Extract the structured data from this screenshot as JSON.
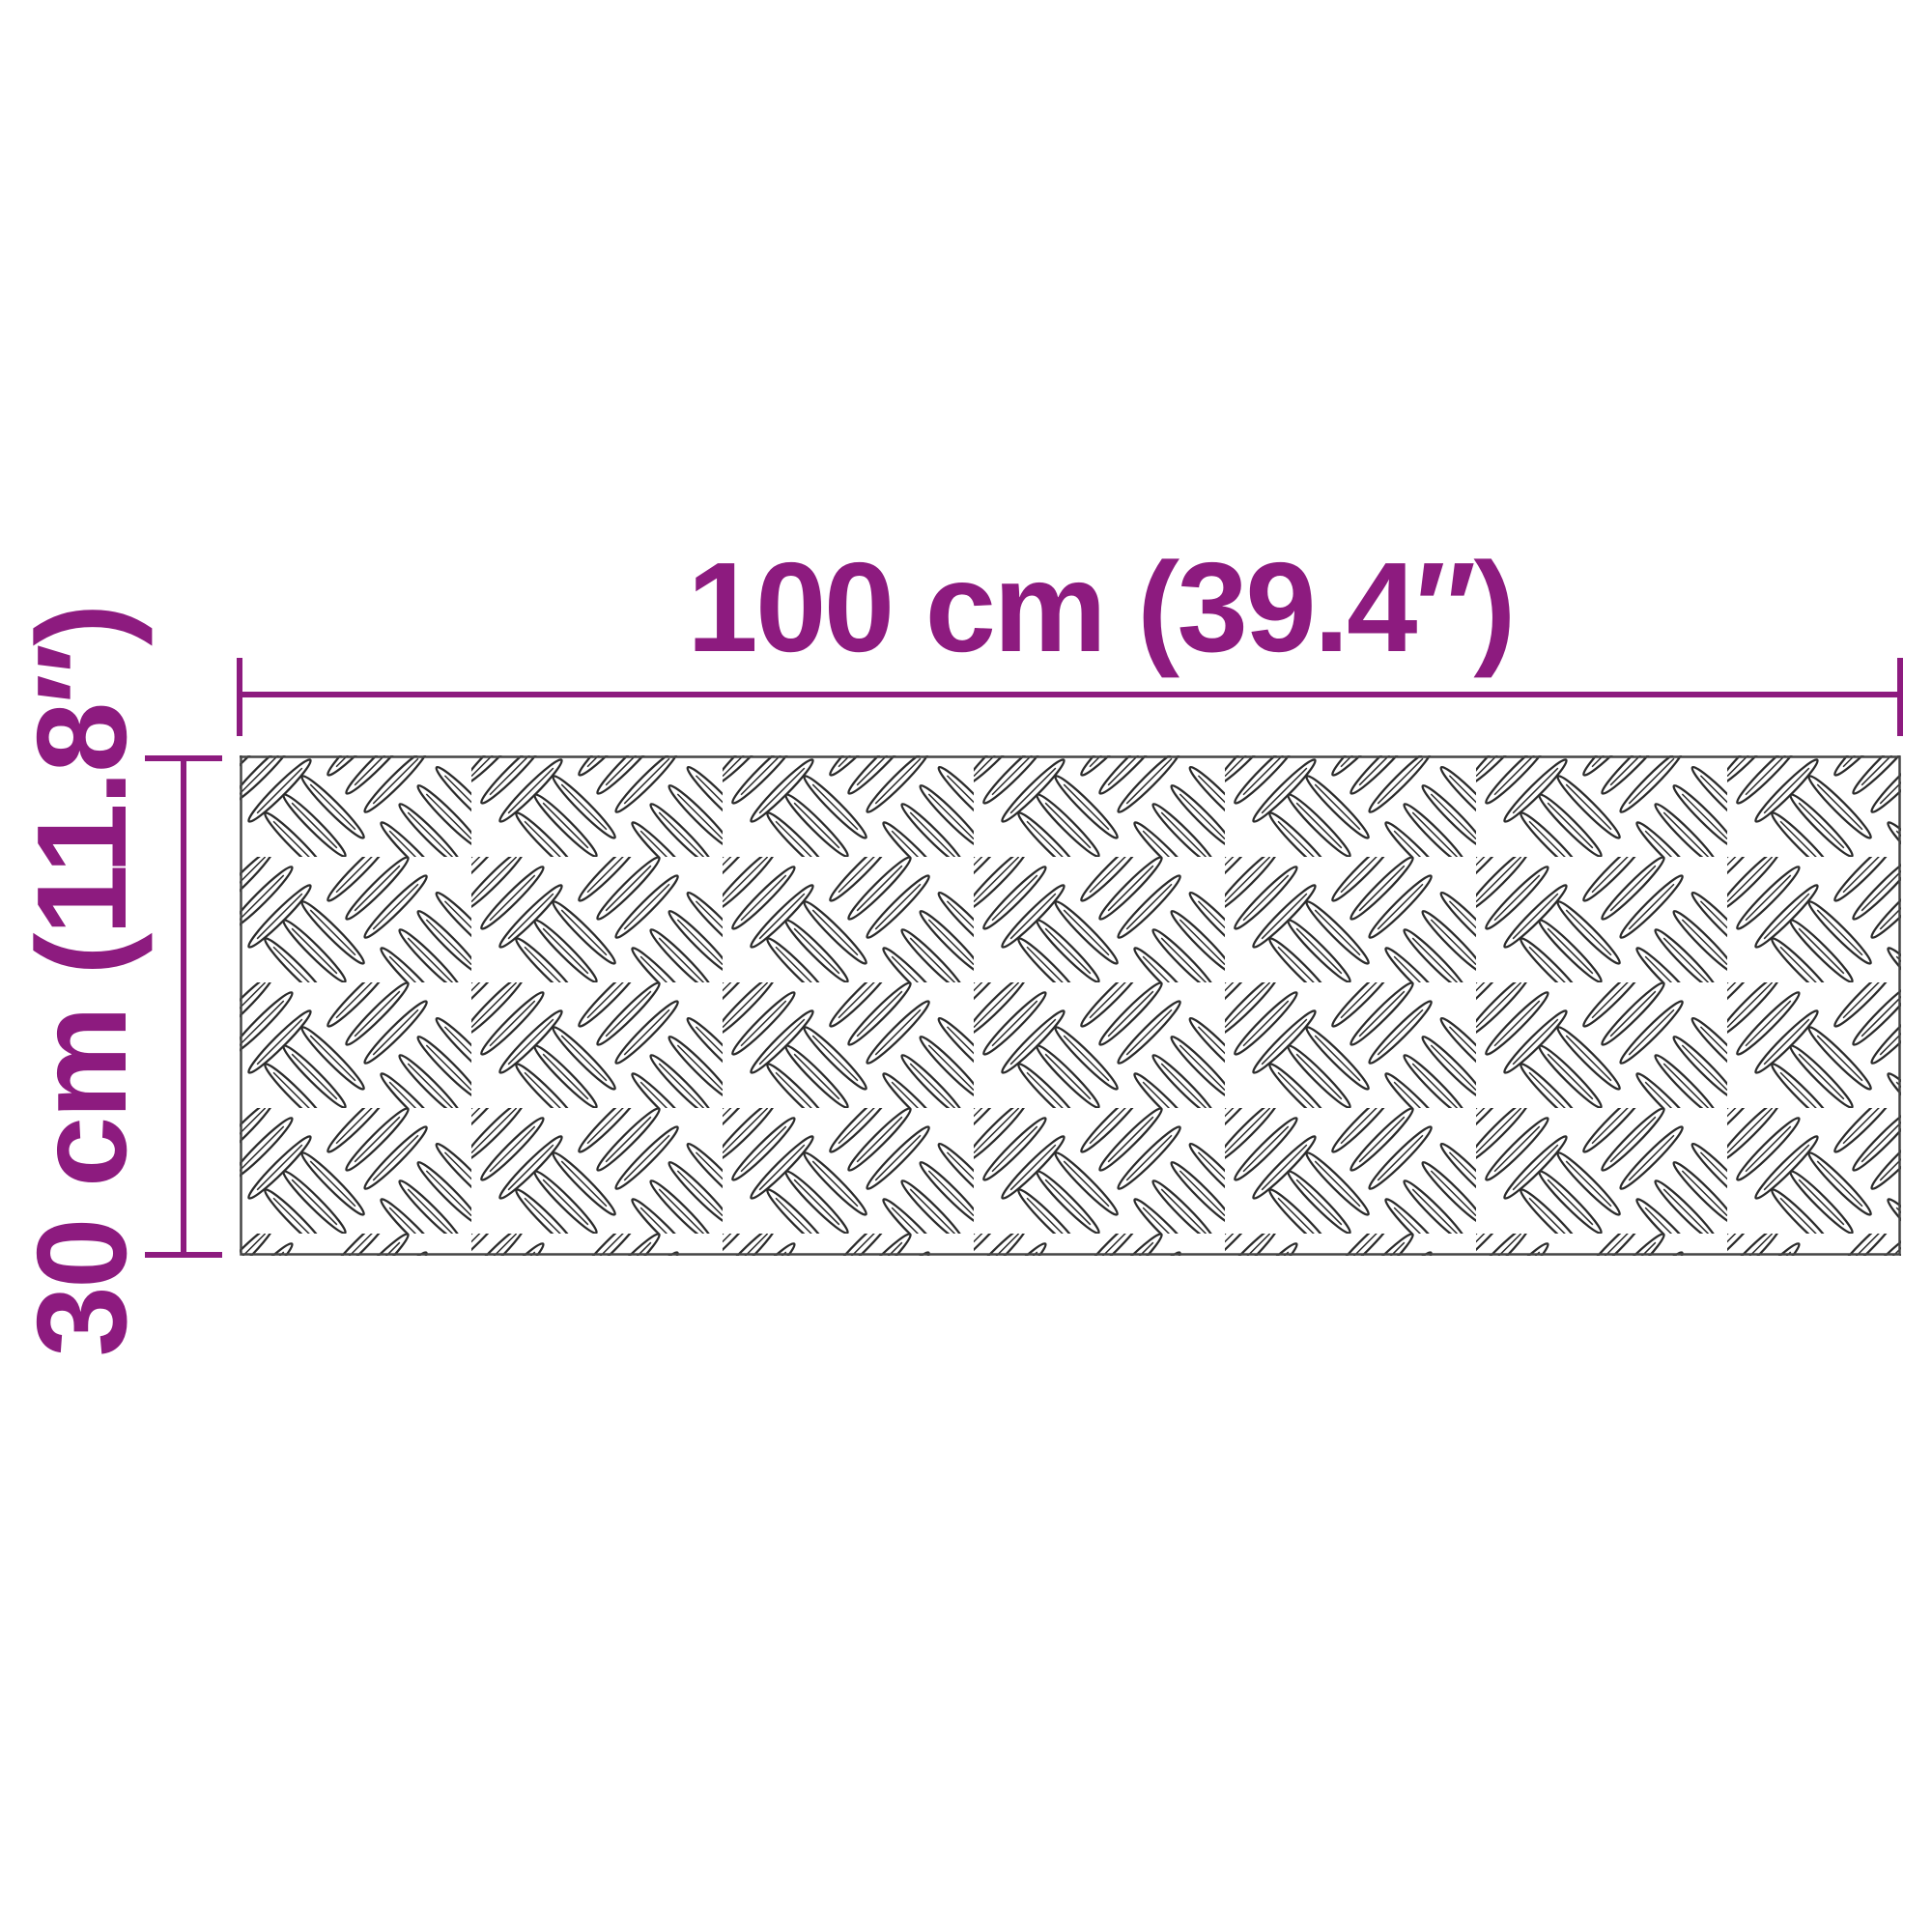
{
  "diagram": {
    "type": "product-dimensions",
    "subject": "checker-plate sheet (diamond tread pattern)",
    "width": {
      "label": "100 cm (39.4″)",
      "cm": "100",
      "inches": "39.4"
    },
    "height": {
      "label": "30 cm (11.8″)",
      "cm": "30",
      "inches": "11.8"
    }
  },
  "colors": {
    "accent": "#8D1B7F",
    "plate-outline": "#454545",
    "tread-mark": "#2B2B2B",
    "background": "#FFFFFF"
  }
}
